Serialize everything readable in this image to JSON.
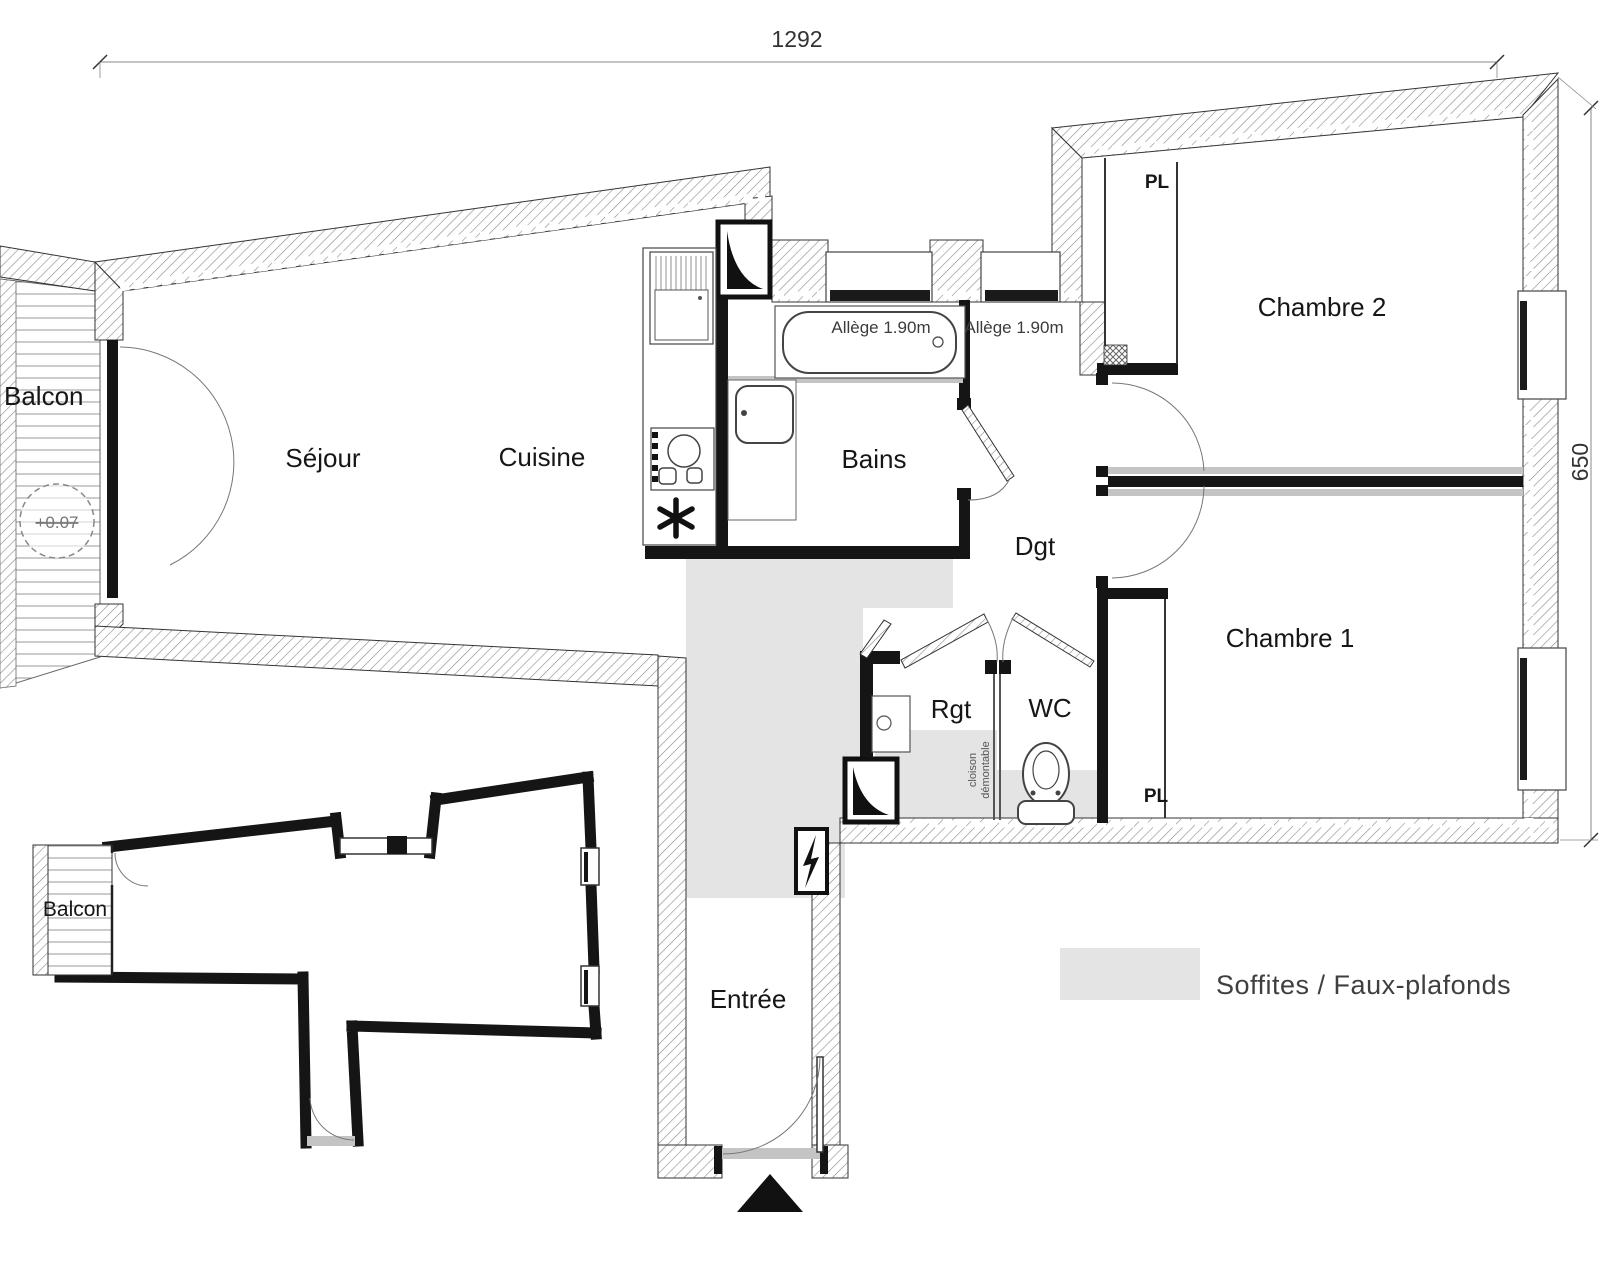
{
  "labels": {
    "sejour": "Séjour",
    "cuisine": "Cuisine",
    "bains": "Bains",
    "dgt": "Dgt",
    "chambre2": "Chambre 2",
    "chambre1": "Chambre 1",
    "rgt": "Rgt",
    "wc": "WC",
    "pl1": "PL",
    "pl2": "PL",
    "entree": "Entrée",
    "balcon_top": "Balcon",
    "balcon_bottom": "Balcon"
  },
  "annotations": {
    "allege1": "Allège 1.90m",
    "allege2": "Allège 1.90m",
    "level": "+0.07",
    "cloison_line1": "cloison",
    "cloison_line2": "démontable"
  },
  "dimensions": {
    "top": "1292",
    "right": "650"
  },
  "legend": {
    "text": "Soffites / Faux-plafonds",
    "swatch_color": "#e4e4e4"
  },
  "colors": {
    "wall": "#151515",
    "soffit": "#e4e4e4",
    "hatch_line": "#777"
  }
}
